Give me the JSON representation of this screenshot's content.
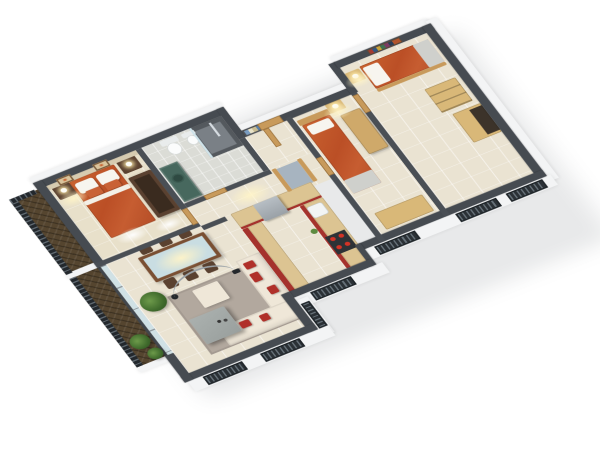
{
  "image_type": "3d-isometric-floor-plan-render",
  "title": "3 bedroom apartment 3D floor plan",
  "palette": {
    "wall_dark": "#464b51",
    "wall_white": "#f3f4f5",
    "floor_tile": "#eae3d2",
    "floor_master": "#e8e0ca",
    "floor_bath": "#dbdcd6",
    "balcony_wood": "#55452f",
    "railing": "#23282d",
    "accent_red": "#a5322c",
    "sofa_cream": "#efe7d8",
    "pillow_red": "#b03029",
    "orange_bedding": "#c05a2e",
    "wood_light": "#d9b878",
    "wood_mid": "#c89a5b",
    "wood_dark": "#5a4130",
    "counter_wood": "#dcc492",
    "teal": "#47685e",
    "teal_dark": "#2f4a42",
    "gray_appliance": "#9aa1a7",
    "rug": "#b2a89e",
    "table_gray": "#9aa09e",
    "glass": "#c9dde2",
    "art_frame": "#d9c49c",
    "plant": "#4e7a3a",
    "glow": "#fff4cc",
    "background": "#ffffff"
  },
  "scene": {
    "style": "cutaway axonometric render, white background, dark gray wall tops, white facades",
    "rooms": [
      {
        "name": "master-bedroom",
        "furniture": [
          "double-bed-orange-bedding",
          "white-and-orange-pillows",
          "nightstand-with-lamp-left",
          "nightstand-with-lamp-right",
          "dark-wood-wardrobe",
          "two-framed-artworks",
          "beige-accent-wall"
        ]
      },
      {
        "name": "bathroom",
        "furniture": [
          "teal-vanity-green-vessel-sink",
          "toilet",
          "bidet",
          "dark-tiled-walk-in-shower",
          "glass-shower-screen",
          "chrome-shower-column"
        ]
      },
      {
        "name": "hallway",
        "furniture": [
          "entry-door",
          "striped-wall-art-panel",
          "storage-nook"
        ]
      },
      {
        "name": "bedroom-2",
        "furniture": [
          "single-bed-orange-bedding",
          "wood-headboard",
          "nightstand-with-lamp",
          "tall-wardrobe",
          "low-sideboard"
        ]
      },
      {
        "name": "bedroom-3",
        "furniture": [
          "single-bed-orange-bedding",
          "wall-book-shelf",
          "nightstand-with-lamp",
          "chest-of-drawers",
          "wardrobe-open"
        ]
      },
      {
        "name": "kitchen",
        "furniture": [
          "l-shaped-counter-red-fronts",
          "wood-countertop",
          "refrigerator",
          "white-sink",
          "cooktop-red-burners",
          "counter-plants"
        ]
      },
      {
        "name": "living-dining-room",
        "furniture": [
          "glass-top-dining-table",
          "six-dark-wood-chairs",
          "potted-plant",
          "cream-corner-sofa",
          "red-accent-pillows",
          "cream-ottoman",
          "arc-floor-lamp",
          "gray-coffee-table",
          "taupe-area-rug"
        ]
      },
      {
        "name": "master-balcony",
        "furniture": [
          "dark-slat-railing",
          "herringbone-wood-deck"
        ]
      },
      {
        "name": "living-balcony",
        "furniture": [
          "dark-slat-railing",
          "herringbone-wood-deck",
          "balcony-plants",
          "glass-window-wall"
        ]
      }
    ],
    "exterior": {
      "shuttered_windows": 7,
      "facade_color": "#f3f4f5",
      "soft_ground_shadow": true
    }
  }
}
